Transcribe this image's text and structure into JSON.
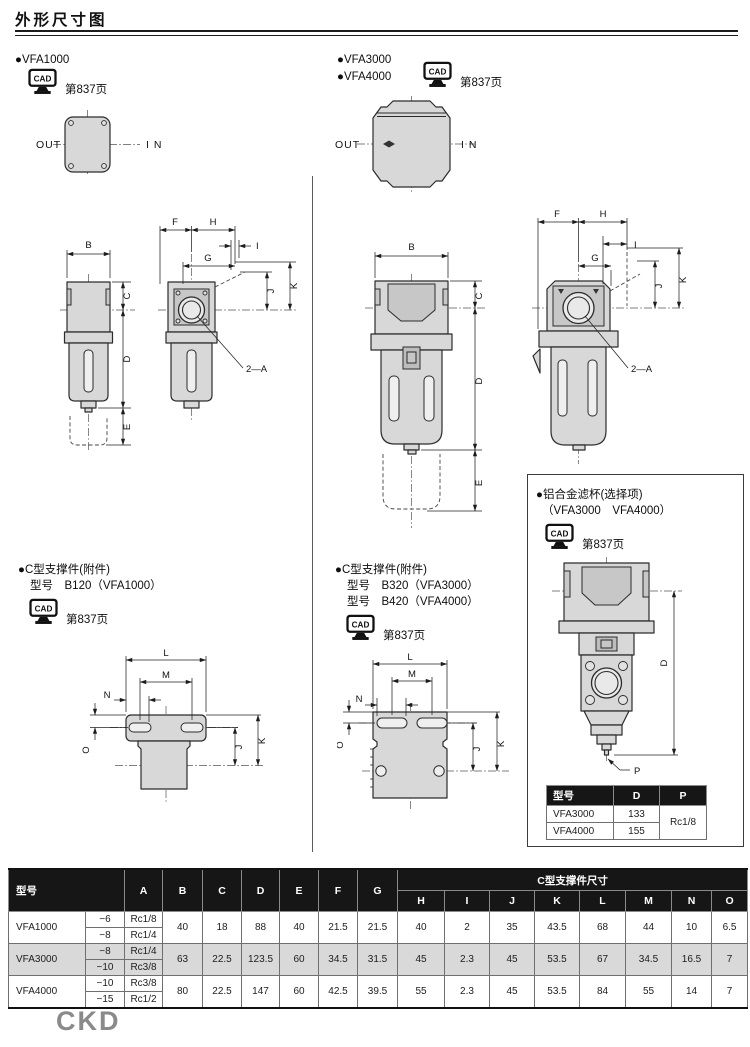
{
  "page": {
    "title": "外形尺寸图",
    "brand": "CKD"
  },
  "labels": {
    "cad": "CAD",
    "cad_page": "第837页",
    "out": "OUT",
    "in": "I N",
    "port_callout": "2—A"
  },
  "dims": {
    "A": "A",
    "B": "B",
    "C": "C",
    "D": "D",
    "E": "E",
    "F": "F",
    "G": "G",
    "H": "H",
    "I": "I",
    "J": "J",
    "K": "K",
    "L": "L",
    "M": "M",
    "N": "N",
    "O": "O",
    "P": "P"
  },
  "sections": {
    "vfa1000": {
      "bullets": [
        "●VFA1000"
      ]
    },
    "vfa3000_4000": {
      "bullets": [
        "●VFA3000",
        "●VFA4000"
      ]
    },
    "bracket_small": {
      "title": "●C型支撑件(附件)",
      "lines": [
        "型号　B120（VFA1000）"
      ]
    },
    "bracket_large": {
      "title": "●C型支撑件(附件)",
      "lines": [
        "型号　B320（VFA3000）",
        "型号　B420（VFA4000）"
      ]
    },
    "metal_bowl": {
      "title": "●铝合金滤杯(选择项)",
      "subtitle": "（VFA3000　VFA4000）",
      "table": {
        "col_model": "型号",
        "col_d": "D",
        "col_p": "P",
        "rows": [
          {
            "model": "VFA3000",
            "d": "133"
          },
          {
            "model": "VFA4000",
            "d": "155"
          }
        ],
        "p_shared": "Rc1/8"
      }
    }
  },
  "main_table": {
    "model_header": "型号",
    "group_header": "C型支撑件尺寸",
    "rows": [
      {
        "model": "VFA1000",
        "variants": [
          {
            "size": "−6",
            "thread": "Rc1/8"
          },
          {
            "size": "−8",
            "thread": "Rc1/4"
          }
        ],
        "b": "40",
        "c": "18",
        "d": "88",
        "e": "40",
        "f": "21.5",
        "g": "21.5",
        "h": "40",
        "i": "2",
        "j": "35",
        "k": "43.5",
        "l": "68",
        "m": "44",
        "n": "10",
        "o": "6.5"
      },
      {
        "model": "VFA3000",
        "variants": [
          {
            "size": "−8",
            "thread": "Rc1/4"
          },
          {
            "size": "−10",
            "thread": "Rc3/8"
          }
        ],
        "b": "63",
        "c": "22.5",
        "d": "123.5",
        "e": "60",
        "f": "34.5",
        "g": "31.5",
        "h": "45",
        "i": "2.3",
        "j": "45",
        "k": "53.5",
        "l": "67",
        "m": "34.5",
        "n": "16.5",
        "o": "7"
      },
      {
        "model": "VFA4000",
        "variants": [
          {
            "size": "−10",
            "thread": "Rc3/8"
          },
          {
            "size": "−15",
            "thread": "Rc1/2"
          }
        ],
        "b": "80",
        "c": "22.5",
        "d": "147",
        "e": "60",
        "f": "42.5",
        "g": "39.5",
        "h": "55",
        "i": "2.3",
        "j": "45",
        "k": "53.5",
        "l": "84",
        "m": "55",
        "n": "14",
        "o": "7"
      }
    ]
  }
}
